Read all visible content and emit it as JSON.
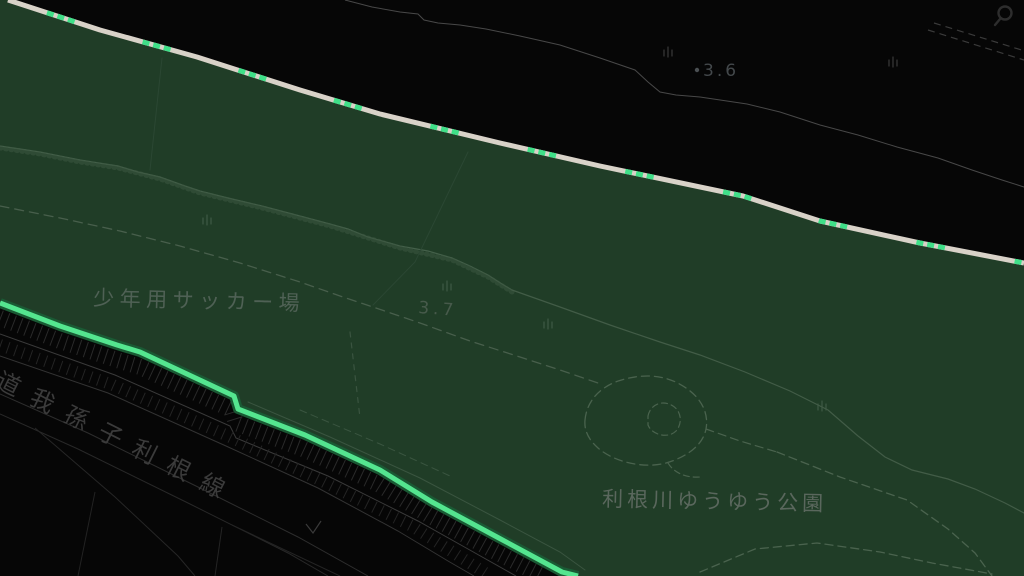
{
  "header": {
    "search_icon": "magnifier"
  },
  "map": {
    "place_labels": [
      {
        "id": "soccer-field",
        "text": "少年用サッカー場"
      },
      {
        "id": "park",
        "text": "利根川ゆうゆう公園"
      },
      {
        "id": "road",
        "text": "道我孫子利根線"
      }
    ],
    "spot_elevations": [
      {
        "value": "3.6"
      },
      {
        "value": "3.7"
      }
    ],
    "colors": {
      "background": "#060606",
      "park_fill": "#203d27",
      "levee_road": "#d8d2c8",
      "route_dash": "#3fdf88",
      "route_highlight": "#54e58f",
      "route_glow": "#1a5a34",
      "minor_path": "#4a634e",
      "road_line": "#3a3a3a"
    }
  }
}
